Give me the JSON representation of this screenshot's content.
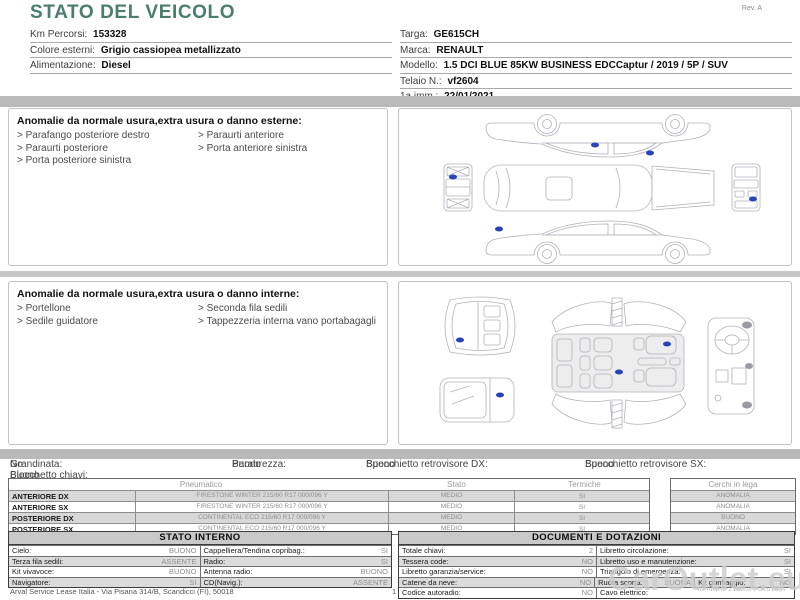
{
  "header": {
    "title": "STATO DEL VEICOLO",
    "rev": "Rev. A"
  },
  "vehicle_info": {
    "left": [
      {
        "label": "Km Percorsi:",
        "value": "153328"
      },
      {
        "label": "Colore esterni:",
        "value": "Grigio cassiopea metallizzato"
      },
      {
        "label": "Alimentazione:",
        "value": "Diesel"
      }
    ],
    "right": [
      {
        "label": "Targa:",
        "value": "GE615CH"
      },
      {
        "label": "Marca:",
        "value": "RENAULT"
      },
      {
        "label": "Modello:",
        "value": "1.5 DCI BLUE 85KW BUSINESS EDCCaptur / 2019 / 5P / SUV"
      },
      {
        "label": "Telaio N.:",
        "value": "vf2604"
      },
      {
        "label": "1a imm.:",
        "value": "22/01/2021"
      }
    ]
  },
  "exterior_anomalies": {
    "title": "Anomalie da normale usura,extra usura o danno esterne:",
    "items_left": [
      "Parafango posteriore destro",
      "Paraurti posteriore",
      "Porta posteriore sinistra"
    ],
    "items_right": [
      "Paraurti anteriore",
      "Porta anteriore sinistra"
    ]
  },
  "interior_anomalies": {
    "title": "Anomalie da normale usura,extra usura o danno interne:",
    "items_left": [
      "Portellone",
      "Sedile guidatore"
    ],
    "items_right": [
      "Seconda fila sedili",
      "Tappezzeria interna vano portabagagli"
    ]
  },
  "general_condition": {
    "row1": [
      {
        "label": "Grandinata:",
        "value": "No"
      },
      {
        "label": "Parabrezza:",
        "value": "Buono"
      },
      {
        "label": "Specchietto retrovisore DX:",
        "value": "Buono"
      },
      {
        "label": "Specchietto retrovisore SX:",
        "value": "Buono"
      }
    ],
    "row2": [
      {
        "label": "Blocchetto chiavi:",
        "value": "Buono"
      }
    ]
  },
  "tyre_table": {
    "headers": {
      "pneumatico": "Pneumatico",
      "stato": "Stato",
      "termiche": "Termiche",
      "cerchi": "Cerchi in lega"
    },
    "rows": [
      {
        "position": "ANTERIORE DX",
        "tyre": "FIRESTONE WINTER 215/60 R17 000/096 Y",
        "stato": "MEDIO",
        "termiche": "SI",
        "cerchi": "ANOMALIA"
      },
      {
        "position": "ANTERIORE SX",
        "tyre": "FIRESTONE WINTER 215/60 R17 000/096 Y",
        "stato": "MEDIO",
        "termiche": "SI",
        "cerchi": "ANOMALIA"
      },
      {
        "position": "POSTERIORE DX",
        "tyre": "CONTINENTAL ECO 215/60 R17 000/096 Y",
        "stato": "MEDIO",
        "termiche": "SI",
        "cerchi": "BUONO"
      },
      {
        "position": "POSTERIORE SX",
        "tyre": "CONTINENTAL ECO 215/60 R17 000/096 Y",
        "stato": "MEDIO",
        "termiche": "SI",
        "cerchi": "ANOMALIA"
      }
    ]
  },
  "stato_interno": {
    "title": "STATO INTERNO",
    "rows": [
      [
        {
          "label": "Cielo:",
          "value": "BUONO"
        },
        {
          "label": "Cappelliera/Tendina copribag.:",
          "value": "SI"
        }
      ],
      [
        {
          "label": "Terza fila sedili:",
          "value": "ASSENTE"
        },
        {
          "label": "Radio:",
          "value": "SI"
        }
      ],
      [
        {
          "label": "Kit vivavoce:",
          "value": "BUONO"
        },
        {
          "label": "Antenna radio:",
          "value": "BUONO"
        }
      ],
      [
        {
          "label": "Navigatore:",
          "value": "SI"
        },
        {
          "label": "CD(Navig.):",
          "value": "ASSENTE"
        }
      ]
    ]
  },
  "documenti_dotazioni": {
    "title": "DOCUMENTI E DOTAZIONI",
    "rows": [
      [
        {
          "label": "Totale chiavi:",
          "value": "2"
        },
        {
          "label": "Libretto circolazione:",
          "value": "SI"
        }
      ],
      [
        {
          "label": "Tessera code:",
          "value": "NO"
        },
        {
          "label": "Libretto uso e manutenzione:",
          "value": "SI"
        }
      ],
      [
        {
          "label": "Libretto garanzia/service:",
          "value": "NO"
        },
        {
          "label": "Triangolo di emergenza:",
          "value": "SI"
        }
      ],
      [
        {
          "label": "Catene da neve:",
          "value": "NO"
        },
        {
          "label": "Ruota scorta:",
          "value": "BUONA"
        },
        {
          "label": "Kit gonfiaggio:",
          "value": "NO"
        }
      ],
      [
        {
          "label": "Codice autoradio:",
          "value": "NO"
        },
        {
          "label": "Cavo elettrico:",
          "value": ""
        }
      ]
    ]
  },
  "footer": {
    "company": "Arval Service Lease Italia - Via Pisana 314/B, Scandicci (FI), 50018",
    "page": "1",
    "doc_id": "ID IuNRJ-21a662 , Gcu18u4"
  },
  "watermark": "CarOutlet.eu",
  "colors": {
    "title_teal": "#4a7d6e",
    "section_bar_gray": "#b9b9b9",
    "damage_marker_blue": "#2843b8",
    "table_header_bg": "#c9c9c9"
  }
}
